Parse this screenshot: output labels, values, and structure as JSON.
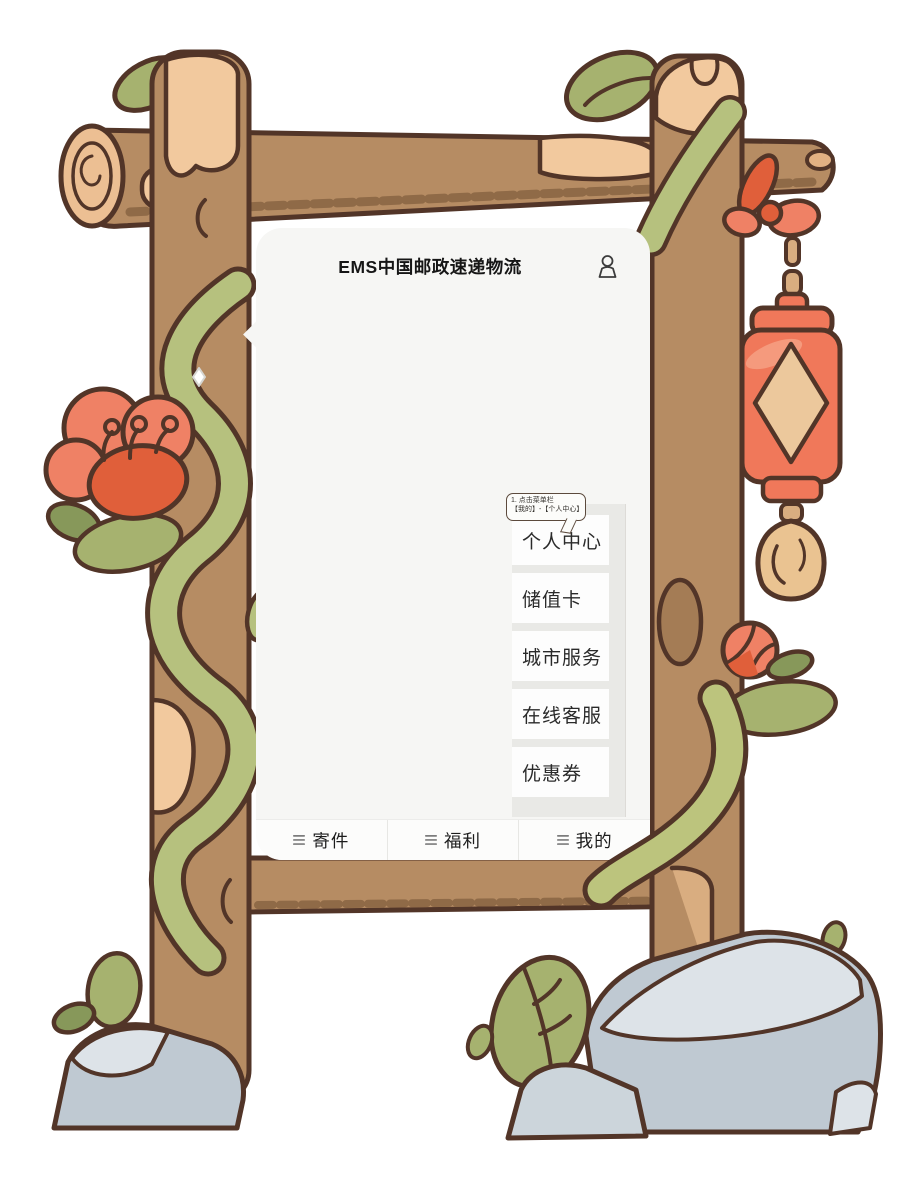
{
  "header": {
    "title": "EMS中国邮政速递物流",
    "profile_icon": "person-outline-icon"
  },
  "tooltip": {
    "line1": "1. 点击菜单栏",
    "line2": "【我的】-【个人中心】"
  },
  "menu": {
    "items": [
      "个人中心",
      "储值卡",
      "城市服务",
      "在线客服",
      "优惠券"
    ]
  },
  "tabbar": {
    "items": [
      {
        "icon": "menu-lines-icon",
        "label": "寄件"
      },
      {
        "icon": "menu-lines-icon",
        "label": "福利"
      },
      {
        "icon": "menu-lines-icon",
        "label": "我的"
      }
    ]
  },
  "colors": {
    "screen_bg": "#f6f6f4",
    "menu_column_bg": "#e9e9e6",
    "menu_cell_bg": "#fdfdfd",
    "tabbar_bg": "#fcfcfb",
    "text": "#1c1c1c",
    "outline": "#523528",
    "wood": "#b68c63",
    "wood_patch": "#f2c99e",
    "vine_green": "#b6c17e",
    "leaf_green": "#a6b26f",
    "flower_coral": "#ef8165",
    "flower_deep": "#e05f3a",
    "lantern_red": "#f0785a",
    "lantern_diamond": "#ecc89c",
    "rock_gray": "#bfc9d2"
  }
}
